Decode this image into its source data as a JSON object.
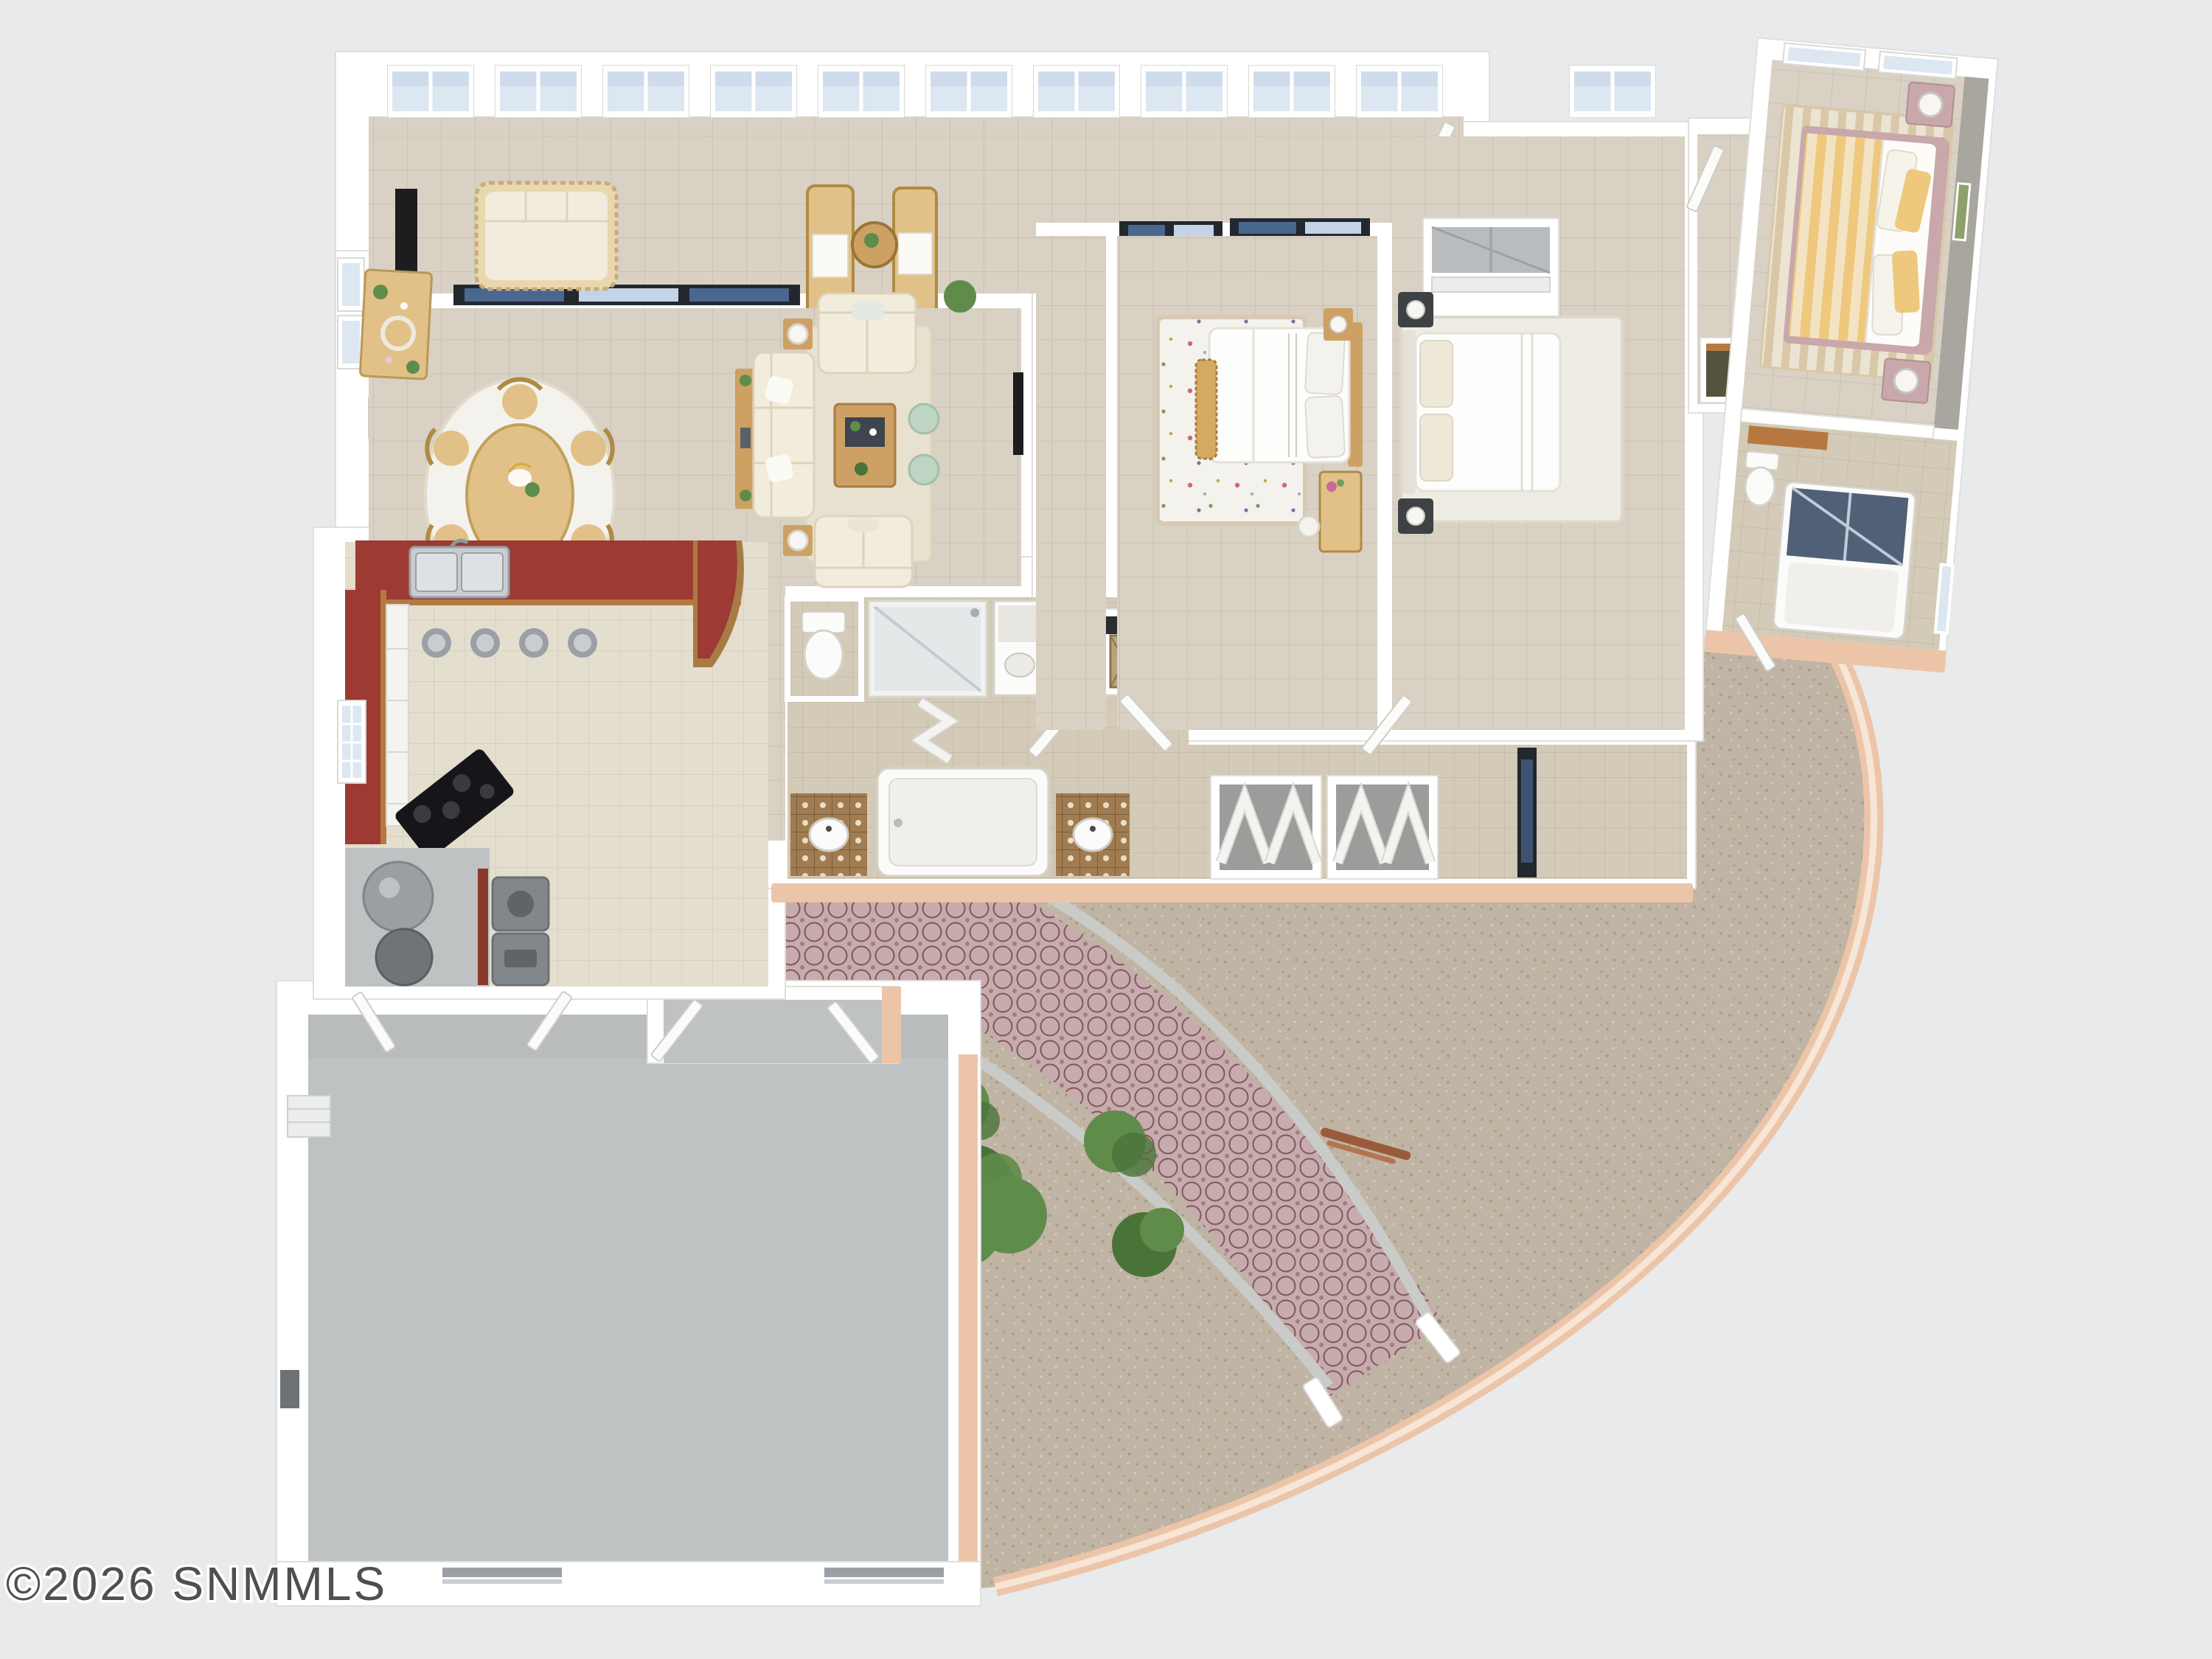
{
  "watermark": {
    "text": "©2026 SNMMLS"
  },
  "scene": {
    "kind": "3d-rendered-floor-plan",
    "view": "top-down dollhouse",
    "rooms": [
      "sunroom-lanai",
      "dining-area",
      "living-room",
      "kitchen",
      "laundry-utility",
      "garage",
      "bathroom-primary",
      "bathroom-guest",
      "hall-closets",
      "bedroom-1",
      "bedroom-2",
      "bedroom-3-casita",
      "bathroom-casita",
      "courtyard",
      "paver-patio"
    ],
    "outdoor_items": [
      "patio-dining-set",
      "wicker-lounge-chairs",
      "shrubs",
      "paver-path",
      "curved-courtyard-wall",
      "gate"
    ]
  },
  "colors": {
    "bg": "#e8eaeb",
    "wall": "#ffffff",
    "wallshadow": "#dfdfdd",
    "doorstroke": "#cfcdc8",
    "tile": "#d8d1c4",
    "tileline": "#c6bfb1",
    "kittile": "#e4decf",
    "kitline": "#d2cbba",
    "bathtile": "#d3cab7",
    "bathline": "#bfb6a2",
    "decotile": "#a07c50",
    "decoline": "#6e5238",
    "kitchenred": "#9c3a33",
    "trimwood": "#b5793f",
    "wood": "#cda164",
    "woodlight": "#e2c188",
    "wooddark": "#a87b45",
    "cream": "#f2ecdd",
    "creamline": "#ddd3bd",
    "rug": "#e9e1d0",
    "rugwhite": "#f4f2ec",
    "mint": "#bdd5c2",
    "gravel": "#c0b4a4",
    "graveldot": "#a99c8a",
    "graveldot2": "#d8cebe",
    "paver": "#c7abae",
    "paverline": "#7c5a57",
    "curb": "#c9cbc8",
    "peach": "#ecc5a9",
    "peachlight": "#f8e8da",
    "garage": "#bfc2c3",
    "concrete2": "#b3b6b7",
    "glass": "#dde7f2",
    "glassdark": "#c3d4e8",
    "sliderframe": "#23272e",
    "sliderglass": "#49678f",
    "appliance": "#82878b",
    "tank": "#9b9fa2",
    "steel": "#c9cdd1",
    "steeldark": "#9aa0a6",
    "redpillow": "#991f29",
    "green": "#5f8c4a",
    "greendark": "#4a7339",
    "yellow": "#eec87c",
    "yellowpale": "#f3e3c2",
    "pinkfurn": "#c8a8ab",
    "accentwall": "#a9a59f",
    "olive": "#55523e",
    "dark": "#1d1d1f",
    "watermark": "#4f4f4f"
  }
}
